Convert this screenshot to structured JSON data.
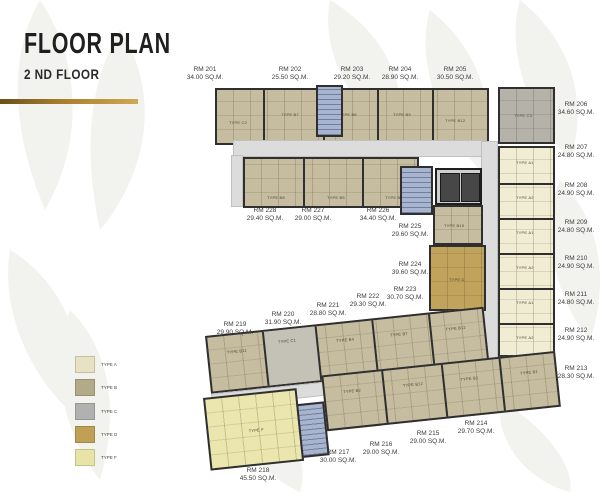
{
  "header": {
    "title": "FLOOR PLAN",
    "subtitle": "2 ND FLOOR"
  },
  "accent": {
    "gold_bar_left": "#6b501d",
    "gold_bar_right": "#cfa954"
  },
  "legend": {
    "items": [
      {
        "label": "TYPE A",
        "color": "#e7e2c4"
      },
      {
        "label": "TYPE B",
        "color": "#b3aa88"
      },
      {
        "label": "TYPE C",
        "color": "#b1b1b1"
      },
      {
        "label": "TYPE D",
        "color": "#bfa055"
      },
      {
        "label": "TYPE F",
        "color": "#e7e4a6"
      }
    ]
  },
  "rooms": [
    {
      "id": "RM 201",
      "area": "34.00 SQ.M."
    },
    {
      "id": "RM 202",
      "area": "25.50 SQ.M."
    },
    {
      "id": "RM 203",
      "area": "29.20 SQ.M."
    },
    {
      "id": "RM 204",
      "area": "28.90 SQ.M."
    },
    {
      "id": "RM 205",
      "area": "30.50 SQ.M."
    },
    {
      "id": "RM 206",
      "area": "34.60 SQ.M."
    },
    {
      "id": "RM 207",
      "area": "24.80 SQ.M."
    },
    {
      "id": "RM 208",
      "area": "24.90 SQ.M."
    },
    {
      "id": "RM 209",
      "area": "24.80 SQ.M."
    },
    {
      "id": "RM 210",
      "area": "24.90 SQ.M."
    },
    {
      "id": "RM 211",
      "area": "24.80 SQ.M."
    },
    {
      "id": "RM 212",
      "area": "24.90 SQ.M."
    },
    {
      "id": "RM 213",
      "area": "28.30 SQ.M."
    },
    {
      "id": "RM 214",
      "area": "29.70 SQ.M."
    },
    {
      "id": "RM 215",
      "area": "29.00 SQ.M."
    },
    {
      "id": "RM 216",
      "area": "29.00 SQ.M."
    },
    {
      "id": "RM 217",
      "area": "30.00 SQ.M."
    },
    {
      "id": "RM 218",
      "area": "45.50 SQ.M."
    },
    {
      "id": "RM 219",
      "area": "29.90 SQ.M."
    },
    {
      "id": "RM 220",
      "area": "31.90 SQ.M."
    },
    {
      "id": "RM 221",
      "area": "28.80 SQ.M."
    },
    {
      "id": "RM 222",
      "area": "29.30 SQ.M."
    },
    {
      "id": "RM 223",
      "area": "30.70 SQ.M."
    },
    {
      "id": "RM 224",
      "area": "39.60 SQ.M."
    },
    {
      "id": "RM 225",
      "area": "29.60 SQ.M."
    },
    {
      "id": "RM 226",
      "area": "34.40 SQ.M."
    },
    {
      "id": "RM 227",
      "area": "29.00 SQ.M."
    },
    {
      "id": "RM 228",
      "area": "29.40 SQ.M."
    }
  ],
  "plan_labels": {
    "c2": "TYPE C2",
    "b7": "TYPE B7",
    "b6": "TYPE B6",
    "b9": "TYPE B9",
    "b12": "TYPE B12",
    "c3": "TYPE C3",
    "a1": "TYPE A1",
    "a2": "TYPE A2",
    "b3": "TYPE B3",
    "b10": "TYPE B10",
    "d": "TYPE D",
    "b8": "TYPE B8",
    "b5": "TYPE B5",
    "b4": "TYPE B4",
    "b11": "TYPE B11",
    "c1": "TYPE C1",
    "b1": "TYPE B1",
    "b2": "TYPE B2",
    "f": "TYPE F"
  },
  "plan_colors": {
    "wall": "#2f2f2f",
    "corridor": "#dcdcdc",
    "stair": "#a8b5d0",
    "elevator_core": "#474747",
    "unit_beige": "#c6bda0",
    "unit_cream": "#f1edd3",
    "unit_gray": "#b5b2a9",
    "unit_gold": "#c2a35b",
    "unit_yellow": "#eae6ae",
    "unit_tan": "#b5ad8b"
  }
}
